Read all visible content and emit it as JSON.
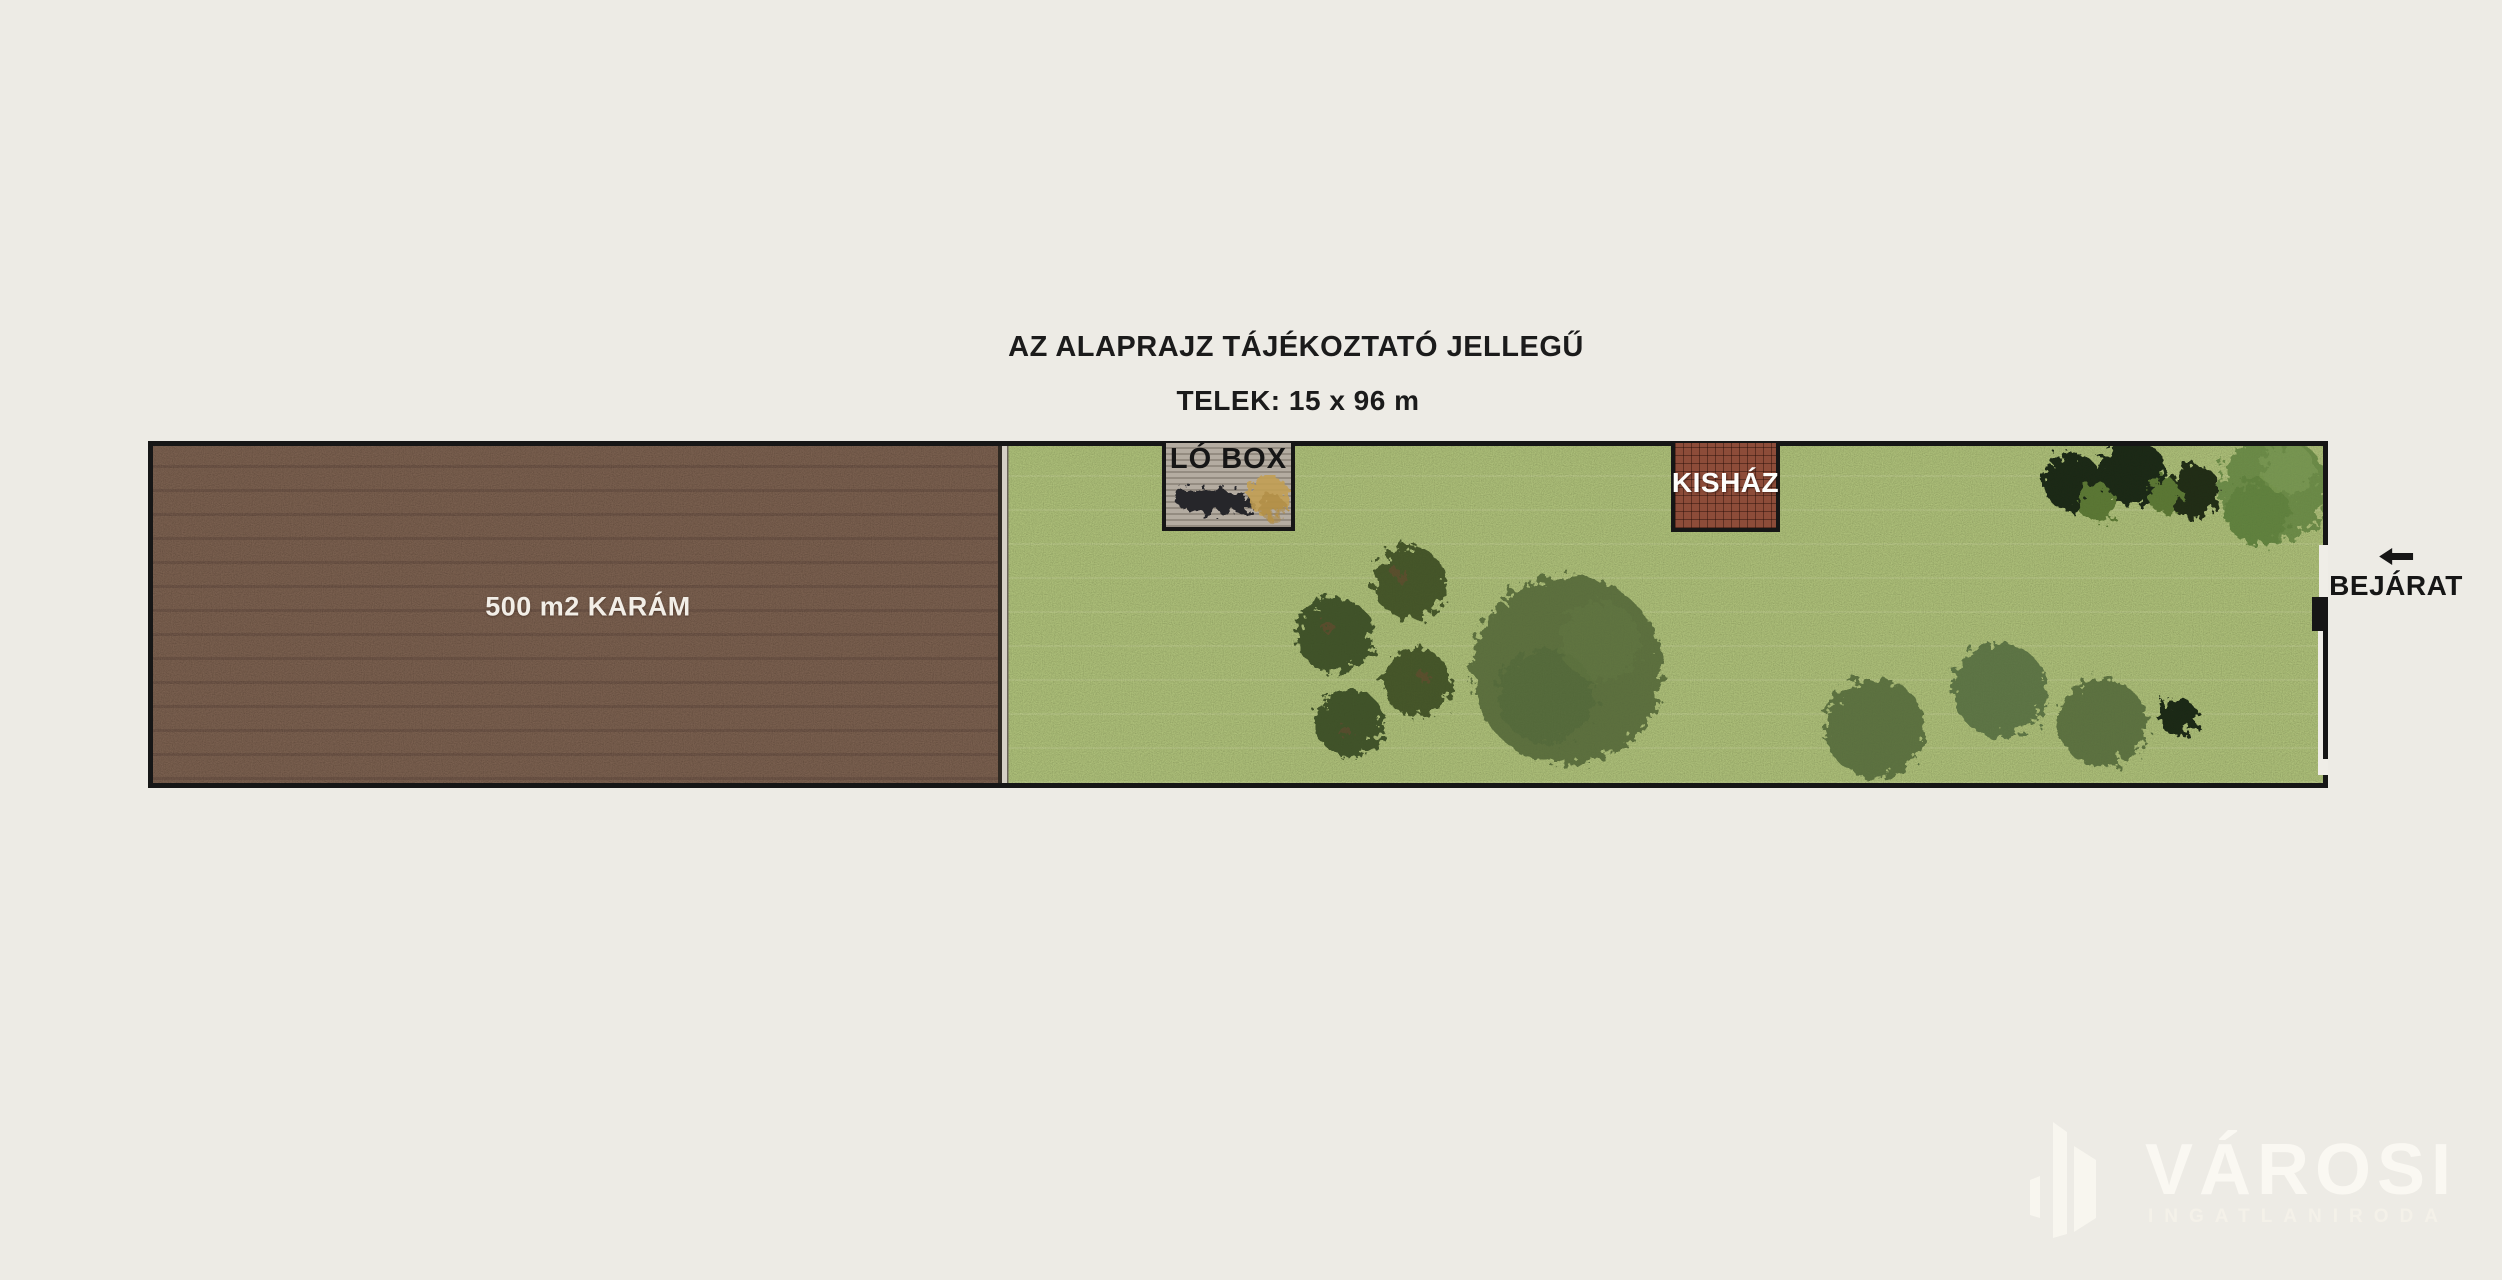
{
  "page": {
    "background_color": "#edebe5"
  },
  "header": {
    "title": "AZ ALAPRAJZ TÁJÉKOZTATÓ JELLEGŰ",
    "plot_size_label": "TELEK: 15 x 96 m"
  },
  "site_plan": {
    "paddock": {
      "label": "500 m2 KARÁM",
      "fill": "#5d4330"
    },
    "horse_box": {
      "label": "LÓ BOX",
      "fill": "#b0a89d"
    },
    "small_house": {
      "label": "KISHÁZ",
      "fill": "#8d4c39"
    },
    "grass_fill": "#93a95c",
    "border_color": "#161616",
    "tree_colors": {
      "olive": "#5e7340",
      "bush": "#46592b",
      "dark": "#1e2a15",
      "bright": "#6e8e49"
    }
  },
  "entrance": {
    "label": "BEJÁRAT",
    "arrow_direction": "left"
  },
  "watermark": {
    "brand": "VÁROSI",
    "subtitle": "INGATLANIRODA"
  }
}
